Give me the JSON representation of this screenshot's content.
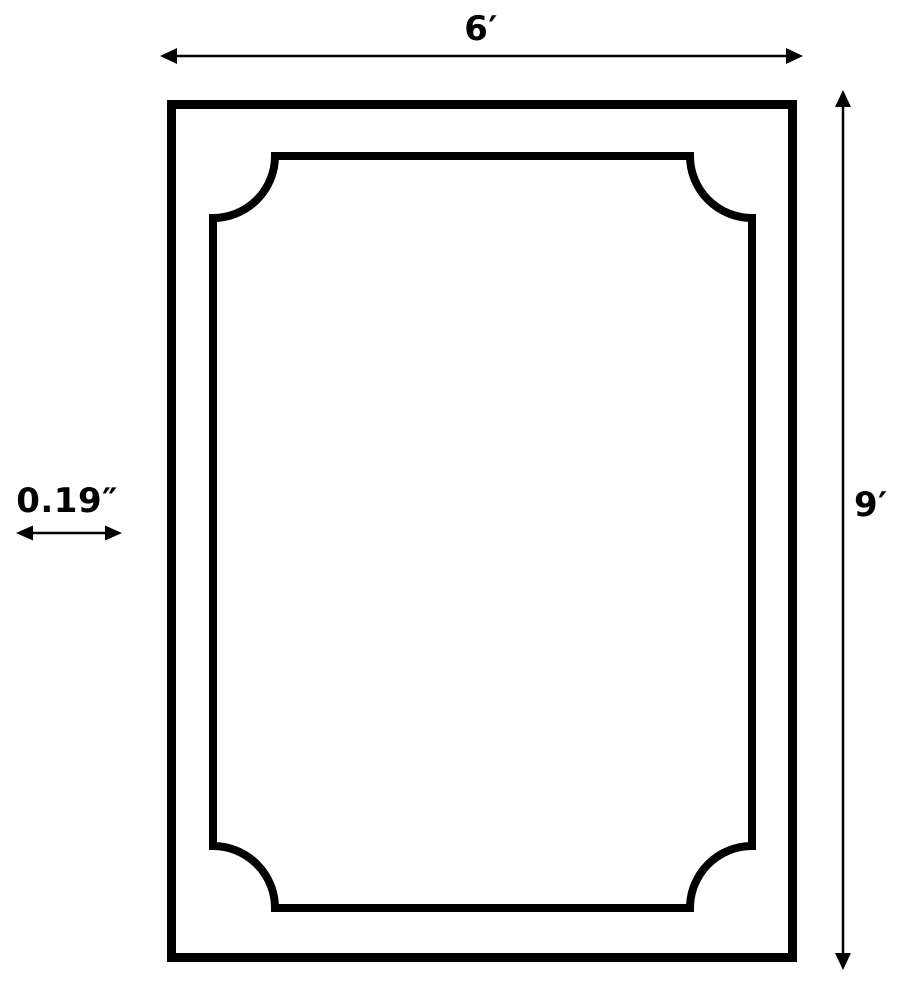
{
  "diagram": {
    "type": "dimension-drawing",
    "subject": "rectangular frame with concave-corner inner border",
    "labels": {
      "width": "6′",
      "height": "9′",
      "thickness": "0.19″"
    },
    "dimensions": {
      "width_value": "6",
      "height_value": "9",
      "thickness_value": "0.19"
    },
    "colors": {
      "line": "#000000",
      "background": "#ffffff"
    }
  }
}
